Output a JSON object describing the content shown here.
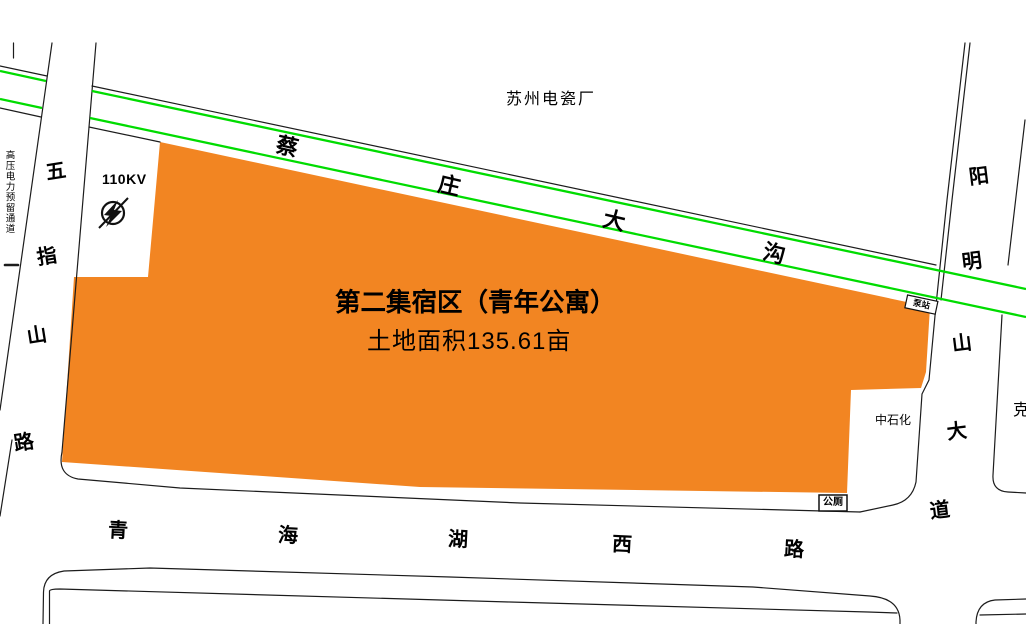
{
  "colors": {
    "parcel_fill": "#F28522",
    "ditch_green": "#00DC00",
    "line_black": "#1c1c1c"
  },
  "parcel": {
    "title": "第二集宿区（青年公寓）",
    "area_label": "土地面积135.61亩"
  },
  "roads": {
    "wuzhishan": {
      "name": "五指山路",
      "chars": [
        "五",
        "指",
        "山",
        "路"
      ]
    },
    "yangmingshan": {
      "name": "阳明山大道",
      "chars": [
        "阳",
        "明",
        "山",
        "大",
        "道"
      ]
    },
    "qinghaihu": {
      "name": "青海湖西路",
      "chars": [
        "青",
        "海",
        "湖",
        "西",
        "路"
      ]
    },
    "caizhuang_ditch": {
      "name": "蔡庄大沟",
      "chars": [
        "蔡",
        "庄",
        "大",
        "沟"
      ]
    }
  },
  "labels": {
    "factory": "苏州电瓷厂",
    "power_corridor": "高压电力预留通道",
    "voltage": "110KV",
    "sinopec": "中石化",
    "public_toilet": "公厕",
    "pump_station": "泵站",
    "clipped_east": "克"
  }
}
